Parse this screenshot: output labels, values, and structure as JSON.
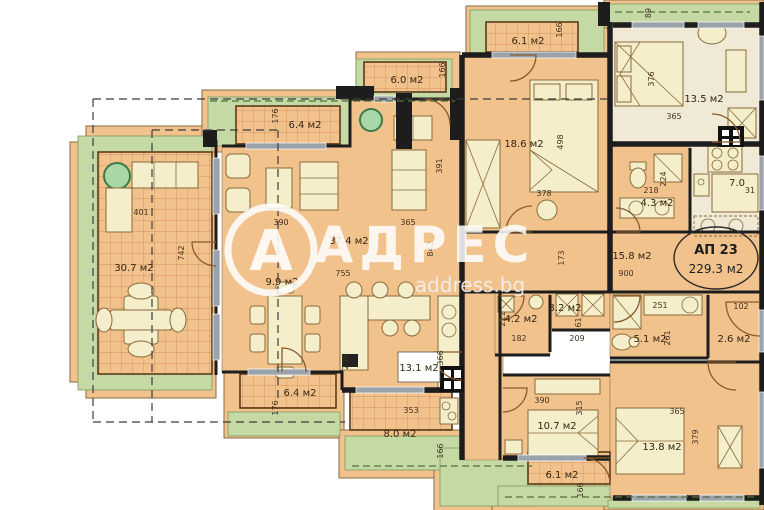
{
  "watermark": {
    "logo_letter": "А",
    "brand": "АДРЕС",
    "site": "address.bg"
  },
  "badge": {
    "unit": "АП 23",
    "area": "229.3 м2"
  },
  "rooms": {
    "terrace": {
      "area": "30.7 м2"
    },
    "balcony_top_left": {
      "area": "6.4 м2"
    },
    "balcony_top": {
      "area": "6.0 м2"
    },
    "living": {
      "area": "37.4 м2"
    },
    "dining": {
      "area": "9.9 м2"
    },
    "bedroom1": {
      "area": "18.6 м2"
    },
    "balcony_top_right": {
      "area": "6.1 м2"
    },
    "bedroom2": {
      "area": "13.5 м2"
    },
    "bathroom1": {
      "area": "4.3 м2"
    },
    "kitchen_niche": {
      "area": "7.0"
    },
    "hallway": {
      "area": "15.8 м2"
    },
    "wc": {
      "area": "4.2 м2"
    },
    "closet": {
      "area": "3.2 м2"
    },
    "bathroom2": {
      "area": "5.1 м2"
    },
    "corridor": {
      "area": "2.6 м2"
    },
    "kitchen": {
      "area": "13.1 м2"
    },
    "balcony_bottom_left": {
      "area": "6.4 м2"
    },
    "balcony_bottom": {
      "area": "8.0 м2"
    },
    "bedroom3": {
      "area": "10.7 м2"
    },
    "balcony_bottom_right": {
      "area": "6.1 м2"
    },
    "bedroom4": {
      "area": "13.8 м2"
    }
  },
  "dims": {
    "terrace_w": "401",
    "terrace_h": "742",
    "balc64t_h": "176",
    "balc64b_h": "176",
    "living_w1": "390",
    "living_w2": "365",
    "living_w_total": "755",
    "living_h": "842",
    "living_right_h": "391",
    "living_door_h": "236",
    "balc60_h": "166",
    "balc61t_h": "166",
    "balc80_h": "166",
    "balc61b_h": "166",
    "bed1_h": "498",
    "bed1_w": "378",
    "bed2_w": "365",
    "bed2_h": "376",
    "bed2_top": "89",
    "bath1_w": "218",
    "bath1_h": "224",
    "niche_w": "31",
    "hall_w": "900",
    "hall_h": "173",
    "wc_h": "221",
    "wc_w": "182",
    "closet_h": "161",
    "closet_w": "209",
    "bath2_w": "251",
    "bath2_h": "261",
    "corridor_w": "102",
    "kitchen_w": "353",
    "kitchen_h": "366",
    "bed3_w": "390",
    "bed3_h": "315",
    "bed4_w": "365",
    "bed4_h": "379"
  },
  "colors": {
    "floor": "#f2c28d",
    "floor_light": "#f0e9d5",
    "green": "#c5d9a5",
    "furniture": "#f4eecb",
    "wall": "#1d1d1d",
    "window": "#9aa2ac",
    "hatch_line": "#c9824e"
  }
}
